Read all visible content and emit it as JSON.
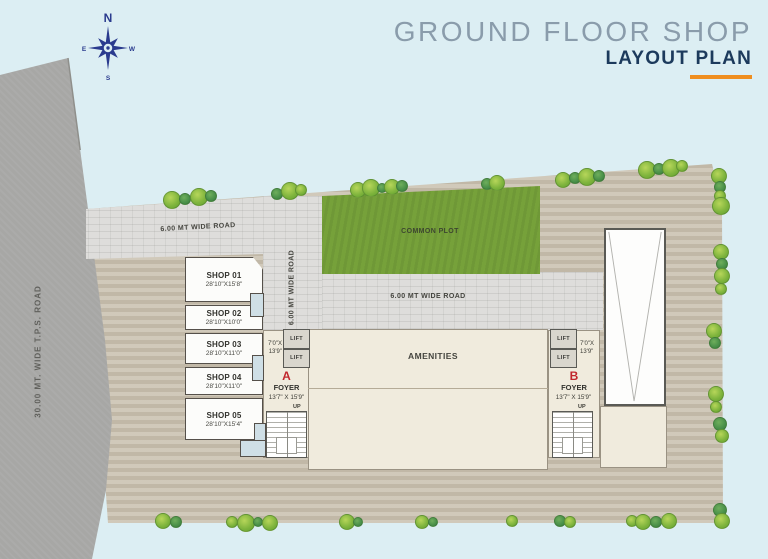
{
  "header": {
    "title": "GROUND FLOOR SHOP",
    "subtitle": "LAYOUT PLAN"
  },
  "compass": {
    "n": "N",
    "e": "E",
    "s": "S",
    "w": "W"
  },
  "roads": {
    "tps": "30.00 MT. WIDE T.P.S. ROAD",
    "top": "6.00 MT WIDE ROAD",
    "vertical": "6.00 MT WIDE ROAD",
    "middle": "6.00 MT WIDE ROAD"
  },
  "areas": {
    "common_plot": "COMMON PLOT",
    "amenities": "AMENITIES"
  },
  "shops": [
    {
      "name": "SHOP 01",
      "size": "28'10\"X15'8\""
    },
    {
      "name": "SHOP 02",
      "size": "28'10\"X10'0\""
    },
    {
      "name": "SHOP 03",
      "size": "28'10\"X11'0\""
    },
    {
      "name": "SHOP 04",
      "size": "28'10\"X11'0\""
    },
    {
      "name": "SHOP 05",
      "size": "28'10\"X15'4\""
    }
  ],
  "foyers": {
    "a": {
      "letter": "A",
      "label": "FOYER",
      "size": "13'7\" X 15'9\"",
      "up": "UP",
      "lift_label": "LIFT",
      "lift_w": "7'0\"X",
      "lift_h": "13'9\""
    },
    "b": {
      "letter": "B",
      "label": "FOYER",
      "size": "13'7\" X 15'9\"",
      "up": "UP",
      "lift_label": "LIFT",
      "lift_w": "7'0\"X",
      "lift_h": "13'9\""
    }
  },
  "colors": {
    "bg": "#dceef3",
    "road_gray": "#a7a7a5",
    "stone": "#dedddb",
    "pavement": "#c9c0af",
    "plot_green": "#76a13a",
    "cream": "#f0ebdd",
    "boundary": "#63635f",
    "red": "#c1272d",
    "navy": "#1c3a5c",
    "title_gray": "#8a9cab",
    "accent": "#ef8e1f",
    "compass_blue": "#2a3b8e"
  }
}
